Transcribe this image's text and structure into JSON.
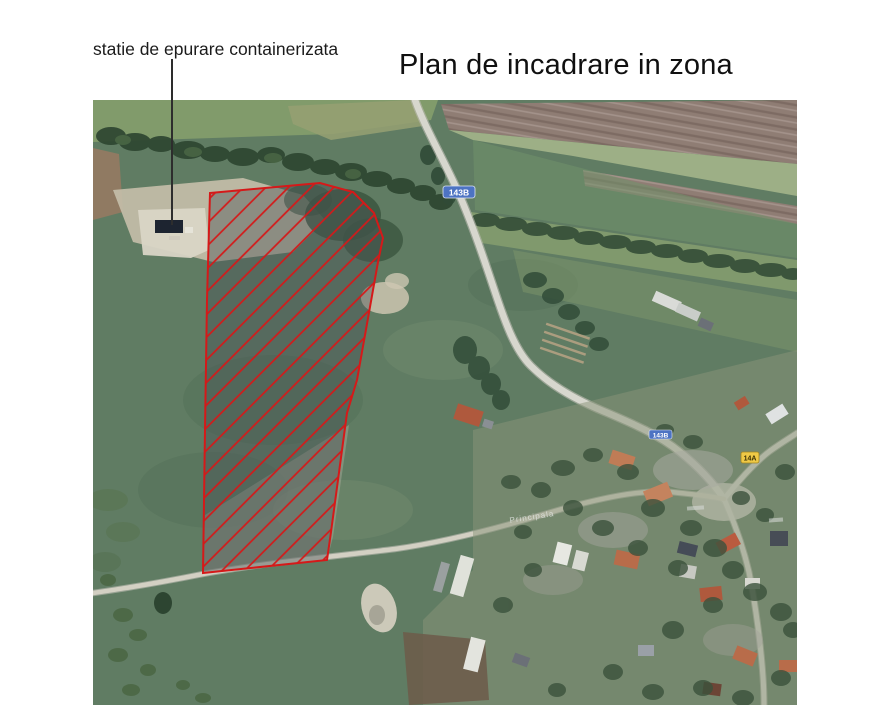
{
  "title": {
    "text": "Plan de incadrare in zona"
  },
  "annotation": {
    "label": "statie de epurare containerizata"
  },
  "map": {
    "street_label": "Principala",
    "road_refs": {
      "blue_main": "143B",
      "blue_secondary": "143B",
      "yellow": "14A"
    },
    "red_zone": {
      "color": "#e01616",
      "points": "117,93 227,83 260,92 281,113 290,138 285,162 264,280 254,313 238,432 234,460 110,473 112,330 114,200",
      "hatch_spacing_px": 16
    }
  },
  "colors": {
    "page_background": "#ffffff",
    "sign_blue": "#4a73c9",
    "sign_yellow": "#f2c93c",
    "pasture_green": "#5e7d62",
    "plowed_field_brown": "#907d73",
    "road_gray": "#d7d7cd"
  }
}
